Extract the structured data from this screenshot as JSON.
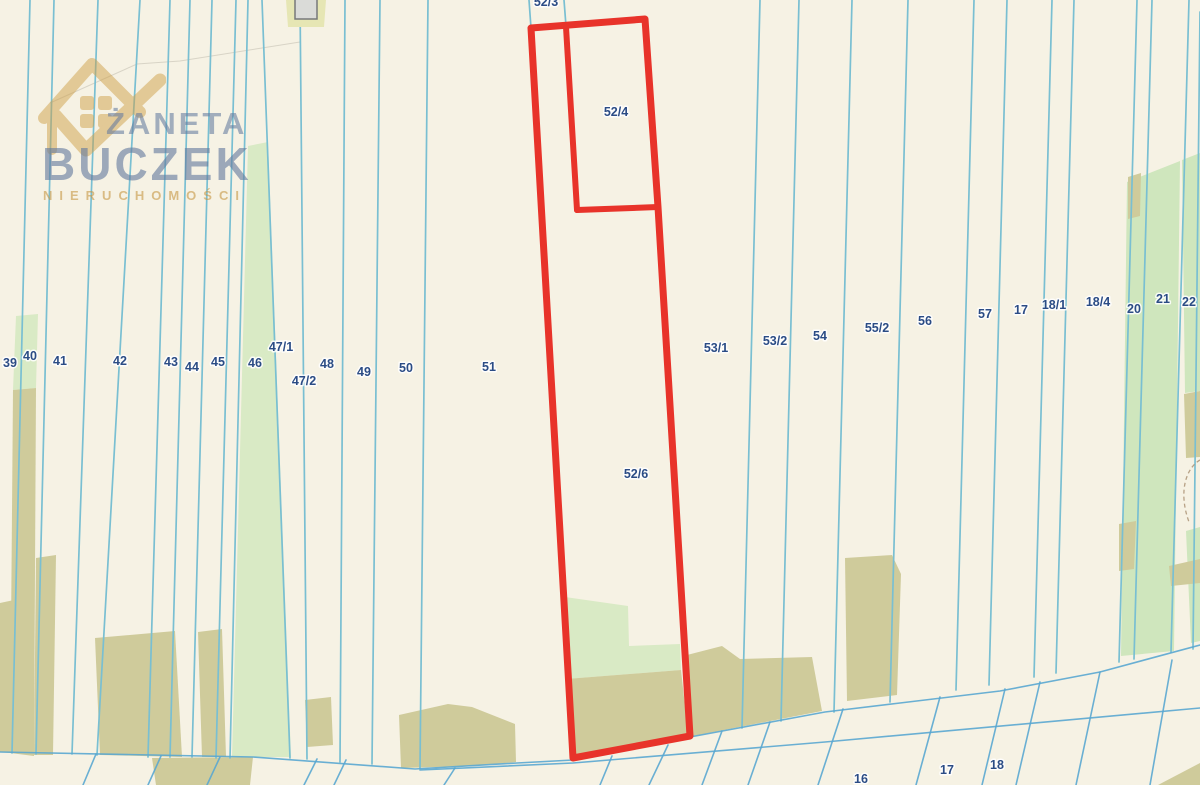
{
  "watermark": {
    "first_name": "ŻANETA",
    "last_name": "BUCZEK",
    "tagline": "NIERUCHOMOŚCI"
  },
  "highlighted_parcels": [
    {
      "label": "52/4",
      "x": 616,
      "y": 116
    },
    {
      "label": "52/6",
      "x": 636,
      "y": 478
    }
  ],
  "parcel_labels": [
    {
      "label": "52/3",
      "x": 546,
      "y": 6
    },
    {
      "label": "39",
      "x": 10,
      "y": 367
    },
    {
      "label": "40",
      "x": 30,
      "y": 360
    },
    {
      "label": "41",
      "x": 60,
      "y": 365
    },
    {
      "label": "42",
      "x": 120,
      "y": 365
    },
    {
      "label": "43",
      "x": 171,
      "y": 366
    },
    {
      "label": "44",
      "x": 192,
      "y": 371
    },
    {
      "label": "45",
      "x": 218,
      "y": 366
    },
    {
      "label": "46",
      "x": 255,
      "y": 367
    },
    {
      "label": "47/1",
      "x": 281,
      "y": 351
    },
    {
      "label": "47/2",
      "x": 304,
      "y": 385
    },
    {
      "label": "48",
      "x": 327,
      "y": 368
    },
    {
      "label": "49",
      "x": 364,
      "y": 376
    },
    {
      "label": "50",
      "x": 406,
      "y": 372
    },
    {
      "label": "51",
      "x": 489,
      "y": 371
    },
    {
      "label": "53/1",
      "x": 716,
      "y": 352
    },
    {
      "label": "53/2",
      "x": 775,
      "y": 345
    },
    {
      "label": "54",
      "x": 820,
      "y": 340
    },
    {
      "label": "55/2",
      "x": 877,
      "y": 332
    },
    {
      "label": "56",
      "x": 925,
      "y": 325
    },
    {
      "label": "57",
      "x": 985,
      "y": 318
    },
    {
      "label": "17",
      "x": 1021,
      "y": 314
    },
    {
      "label": "18/1",
      "x": 1054,
      "y": 309
    },
    {
      "label": "18/4",
      "x": 1098,
      "y": 306
    },
    {
      "label": "20",
      "x": 1134,
      "y": 313
    },
    {
      "label": "21",
      "x": 1163,
      "y": 303
    },
    {
      "label": "22",
      "x": 1189,
      "y": 306
    },
    {
      "label": "16",
      "x": 861,
      "y": 783
    },
    {
      "label": "17",
      "x": 947,
      "y": 774
    },
    {
      "label": "18",
      "x": 997,
      "y": 769
    }
  ],
  "colors": {
    "background": "#f6f2e4",
    "boundary_line": "#79bfd2",
    "boundary_line_dark": "#5aa7d0",
    "green_area": "#d9eac5",
    "green_area_right": "#cfe6bd",
    "olive_area": "#cfcb9b",
    "highlight_red": "#e8332a",
    "label_text": "#2b4c85",
    "logo_gold": "#cfa14a",
    "logo_blue": "#8ba0bf"
  }
}
